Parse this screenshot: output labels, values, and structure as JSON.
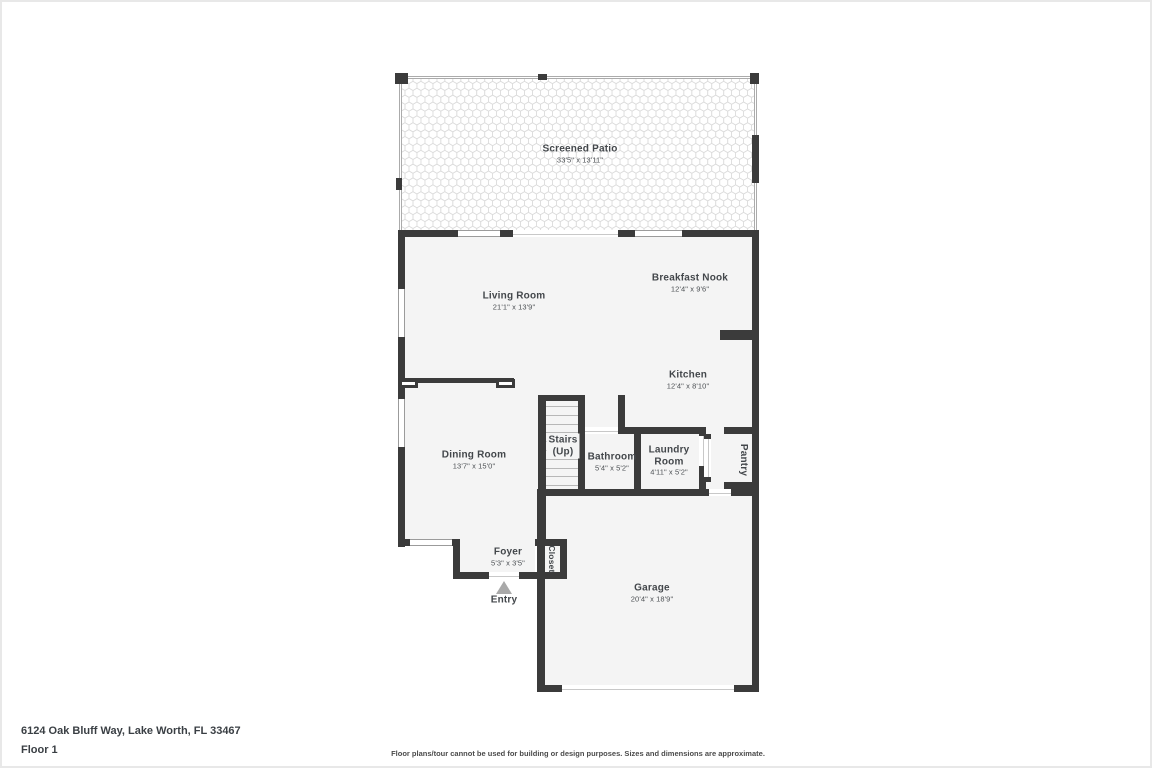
{
  "plan": {
    "rooms": {
      "screened_patio": {
        "name": "Screened Patio",
        "dims": "33'5\" x 13'11\""
      },
      "living_room": {
        "name": "Living Room",
        "dims": "21'1\" x 13'9\""
      },
      "breakfast_nook": {
        "name": "Breakfast Nook",
        "dims": "12'4\" x 9'6\""
      },
      "kitchen": {
        "name": "Kitchen",
        "dims": "12'4\" x 8'10\""
      },
      "stairs": {
        "name": "Stairs",
        "name2": "(Up)"
      },
      "bathroom": {
        "name": "Bathroom",
        "dims": "5'4\" x 5'2\""
      },
      "laundry_room": {
        "name": "Laundry",
        "name2": "Room",
        "dims": "4'11\" x 5'2\""
      },
      "pantry": {
        "name": "Pantry"
      },
      "dining_room": {
        "name": "Dining Room",
        "dims": "13'7\" x 15'0\""
      },
      "foyer": {
        "name": "Foyer",
        "dims": "5'3\" x 3'5\""
      },
      "closet": {
        "name": "Closet"
      },
      "entry": {
        "name": "Entry"
      },
      "garage": {
        "name": "Garage",
        "dims": "20'4\" x 18'9\""
      }
    },
    "footer": {
      "address": "6124 Oak Bluff Way, Lake Worth, FL 33467",
      "floor_label": "Floor 1",
      "disclaimer": "Floor plans/tour cannot be used for building or design purposes. Sizes and dimensions are approximate."
    },
    "colors": {
      "wall": "#3b3b3b",
      "room_fill": "#f4f4f4",
      "screen_line": "#ababab",
      "pattern_line": "#dcdcdc",
      "entry_arrow": "#a9a9a9"
    }
  }
}
